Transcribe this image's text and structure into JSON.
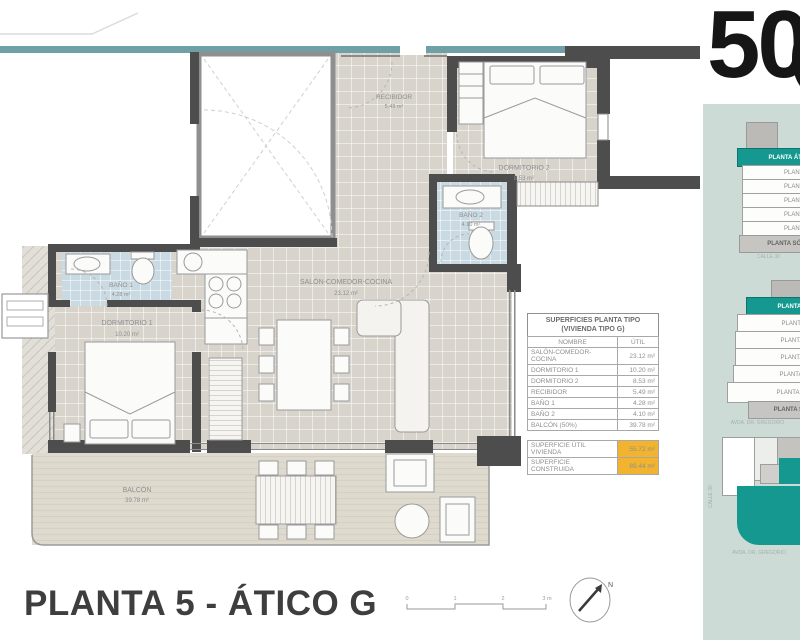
{
  "header": {
    "big_number": "50"
  },
  "floor_plan": {
    "rooms": [
      {
        "name": "RECIBIDOR",
        "area": "5.49 m²"
      },
      {
        "name": "DORMITORIO 2",
        "area": "8.53 m²"
      },
      {
        "name": "BAÑO 2",
        "area": "4.10 m²"
      },
      {
        "name": "BAÑO 1",
        "area": "4.28 m²"
      },
      {
        "name": "DORMITORIO 1",
        "area": "10.20 m²"
      },
      {
        "name": "SALÓN-COMEDOR-COCINA",
        "area": "23.12 m²"
      },
      {
        "name": "BALCÓN",
        "area": "39.78 m²"
      }
    ]
  },
  "areas_table": {
    "title_line1": "SUPERFICIES PLANTA TIPO",
    "title_line2": "(VIVIENDA TIPO G)",
    "columns": {
      "name": "NOMBRE",
      "util": "ÚTIL"
    },
    "rows": [
      {
        "name": "SALÓN-COMEDOR-COCINA",
        "util": "23.12 m²"
      },
      {
        "name": "DORMITORIO 1",
        "util": "10.20 m²"
      },
      {
        "name": "DORMITORIO 2",
        "util": "8.53 m²"
      },
      {
        "name": "RECIBIDOR",
        "util": "5.49 m²"
      },
      {
        "name": "BAÑO 1",
        "util": "4.28 m²"
      },
      {
        "name": "BAÑO 2",
        "util": "4.10 m²"
      },
      {
        "name": "BALCÓN (50%)",
        "util": "39.78 m²"
      }
    ],
    "summary": [
      {
        "label": "SUPERFICIE ÚTIL VIVIENDA",
        "value": "55.72 m²"
      },
      {
        "label": "SUPERFICIE CONSTRUIDA",
        "value": "89.44 m²"
      }
    ]
  },
  "footer": {
    "title": "PLANTA 5 - ÁTICO G",
    "scale_labels": [
      "0",
      "1",
      "2",
      "3 m"
    ],
    "north_label": "N"
  },
  "sidebar": {
    "building_stacks": [
      {
        "floors": [
          "PLANTA ÁTICO",
          "PLANTA",
          "PLANTA",
          "PLANTA",
          "PLANTA",
          "PLANTA",
          "PLANTA SÓTANO"
        ],
        "street": "CALLE 30"
      },
      {
        "floors": [
          "PLANTA ÁTICO",
          "PLANTA",
          "PLANTA",
          "PLANTA",
          "PLANTA",
          "PLANTA",
          "PLANTA SÓTANO"
        ],
        "street": "AVDA. DR. GREGORIO"
      }
    ],
    "site_plan": {
      "street_bottom": "AVDA. DR. GREGORIO",
      "street_side": "CALLE 30"
    }
  },
  "colors": {
    "accent_teal": "#15988f",
    "band_teal": "#6fa0a5",
    "panel_bg": "#ccdbd5",
    "highlight_orange": "#f2b42e",
    "wall": "#4d4d4d"
  }
}
